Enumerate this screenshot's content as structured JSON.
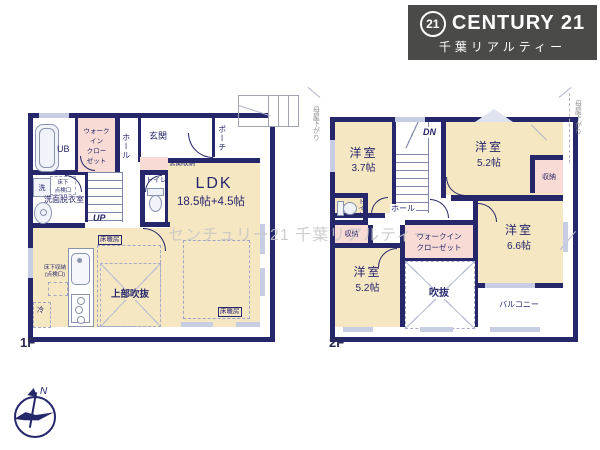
{
  "logo": {
    "badge": "21",
    "brand": "CENTURY 21",
    "subtitle": "千葉リアルティー"
  },
  "watermark": "センチュリー21 千葉リアルティー",
  "compass": {
    "north_label": "N"
  },
  "floor1": {
    "label": "1F",
    "ub": "UB",
    "wic_lines": [
      "ウォーク",
      "イン",
      "クロー",
      "ゼット"
    ],
    "hall": "ホール",
    "entrance": "玄関",
    "porch": "ポーチ",
    "entrance_storage": "玄関収納",
    "toilet": "トイレ",
    "up": "UP",
    "wash": "洗",
    "underfloor_hatch_lines": [
      "床下",
      "点検口"
    ],
    "washroom": "洗面脱衣室",
    "ldk": "LDK",
    "ldk_size": "18.5帖+4.5帖",
    "floor_heating_a": "床暖房",
    "floor_heating_b": "床暖房",
    "underfloor_storage_lines": [
      "床下収納",
      "(点検口)"
    ],
    "fridge": "冷",
    "open_ceiling": "上部吹抜"
  },
  "floor2": {
    "label": "2F",
    "room_a": {
      "name": "洋室",
      "size": "3.7帖"
    },
    "room_b": {
      "name": "洋室",
      "size": "5.2帖"
    },
    "room_c": {
      "name": "洋室",
      "size": "5.2帖"
    },
    "room_d": {
      "name": "洋室",
      "size": "6.6帖"
    },
    "dn": "DN",
    "hall": "ホール",
    "toilet": "トイレ",
    "storage_a": "収納",
    "storage_b": "収納",
    "wic_lines": [
      "ウォークイン",
      "クローゼット"
    ],
    "void": "吹抜",
    "balcony": "バルコニー",
    "moya_sagari_left": "母屋下がり",
    "moya_sagari_right": "母屋下がり"
  },
  "colors": {
    "wall": "#26266b",
    "room_cream": "#f6e7c3",
    "closet_pink": "#f9dbd5",
    "window": "#c7cde2",
    "logo_bg": "#4a4a49",
    "watermark": "#c6c6c6",
    "moya_gray": "#8d8d8d"
  }
}
